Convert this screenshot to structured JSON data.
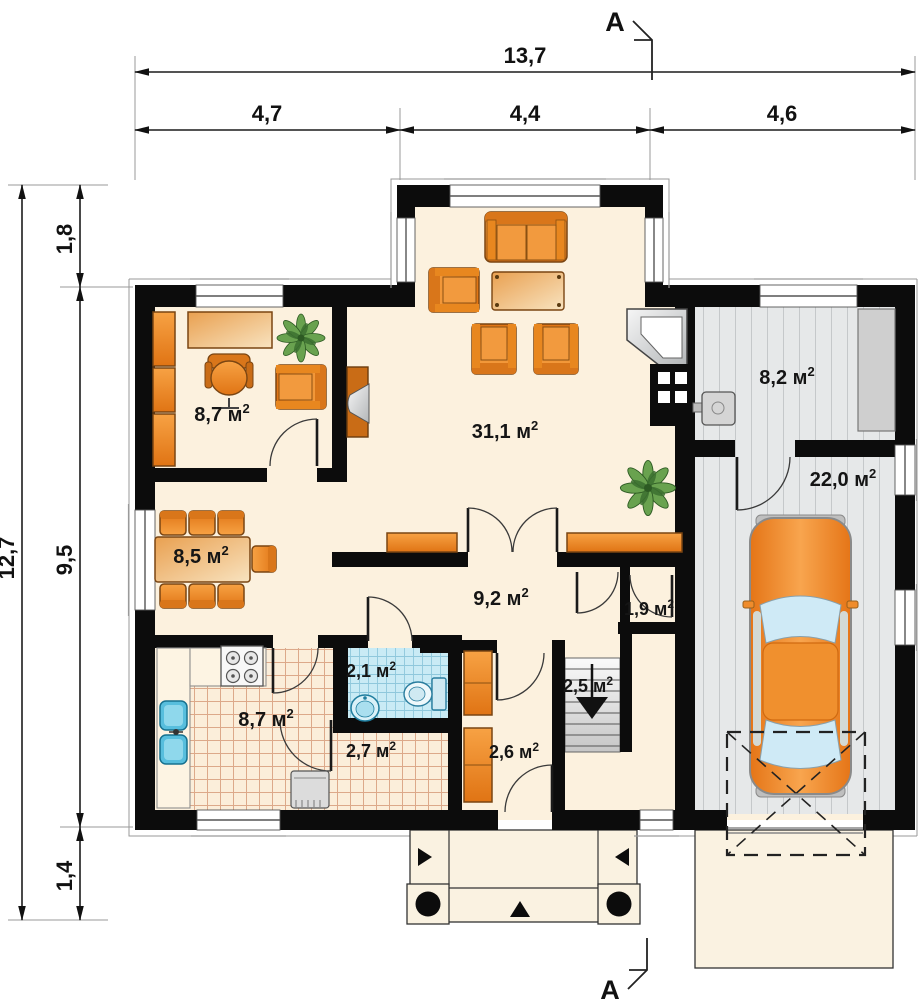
{
  "dimensions": {
    "top_total": "13,7",
    "top_segments": [
      "4,7",
      "4,4",
      "4,6"
    ],
    "left_total": "12,7",
    "left_segments": [
      "1,8",
      "9,5",
      "1,4"
    ]
  },
  "section_marker": "A",
  "area_superscript": "2",
  "rooms": [
    {
      "id": "office",
      "area": "8,7 м"
    },
    {
      "id": "living-room",
      "area": "31,1 м"
    },
    {
      "id": "storage",
      "area": "8,2 м"
    },
    {
      "id": "garage",
      "area": "22,0 м"
    },
    {
      "id": "dining-room",
      "area": "8,5 м"
    },
    {
      "id": "hall",
      "area": "9,2 м"
    },
    {
      "id": "pantry",
      "area": "1,9 м"
    },
    {
      "id": "staircase",
      "area": "2,5 м"
    },
    {
      "id": "bathroom",
      "area": "2,1 м"
    },
    {
      "id": "kitchen",
      "area": "8,7 м"
    },
    {
      "id": "corridor",
      "area": "2,7 м"
    },
    {
      "id": "entry-hall",
      "area": "2,6 м"
    }
  ],
  "colors": {
    "wall": "#0c0c0c",
    "floor_cream": "#fcf1de",
    "furniture_orange": "#ee8c2e",
    "plank_gray": "#e6e8e9",
    "bath_tile_blue": "#c9ebf5",
    "kitchen_tile_line": "#dca98a",
    "table_peach": "#f3d9b0",
    "car_orange": "#f08a30",
    "fixture_blue": "#57bedd",
    "plant_green": "#69a24f",
    "dimension_text": "#111111"
  }
}
